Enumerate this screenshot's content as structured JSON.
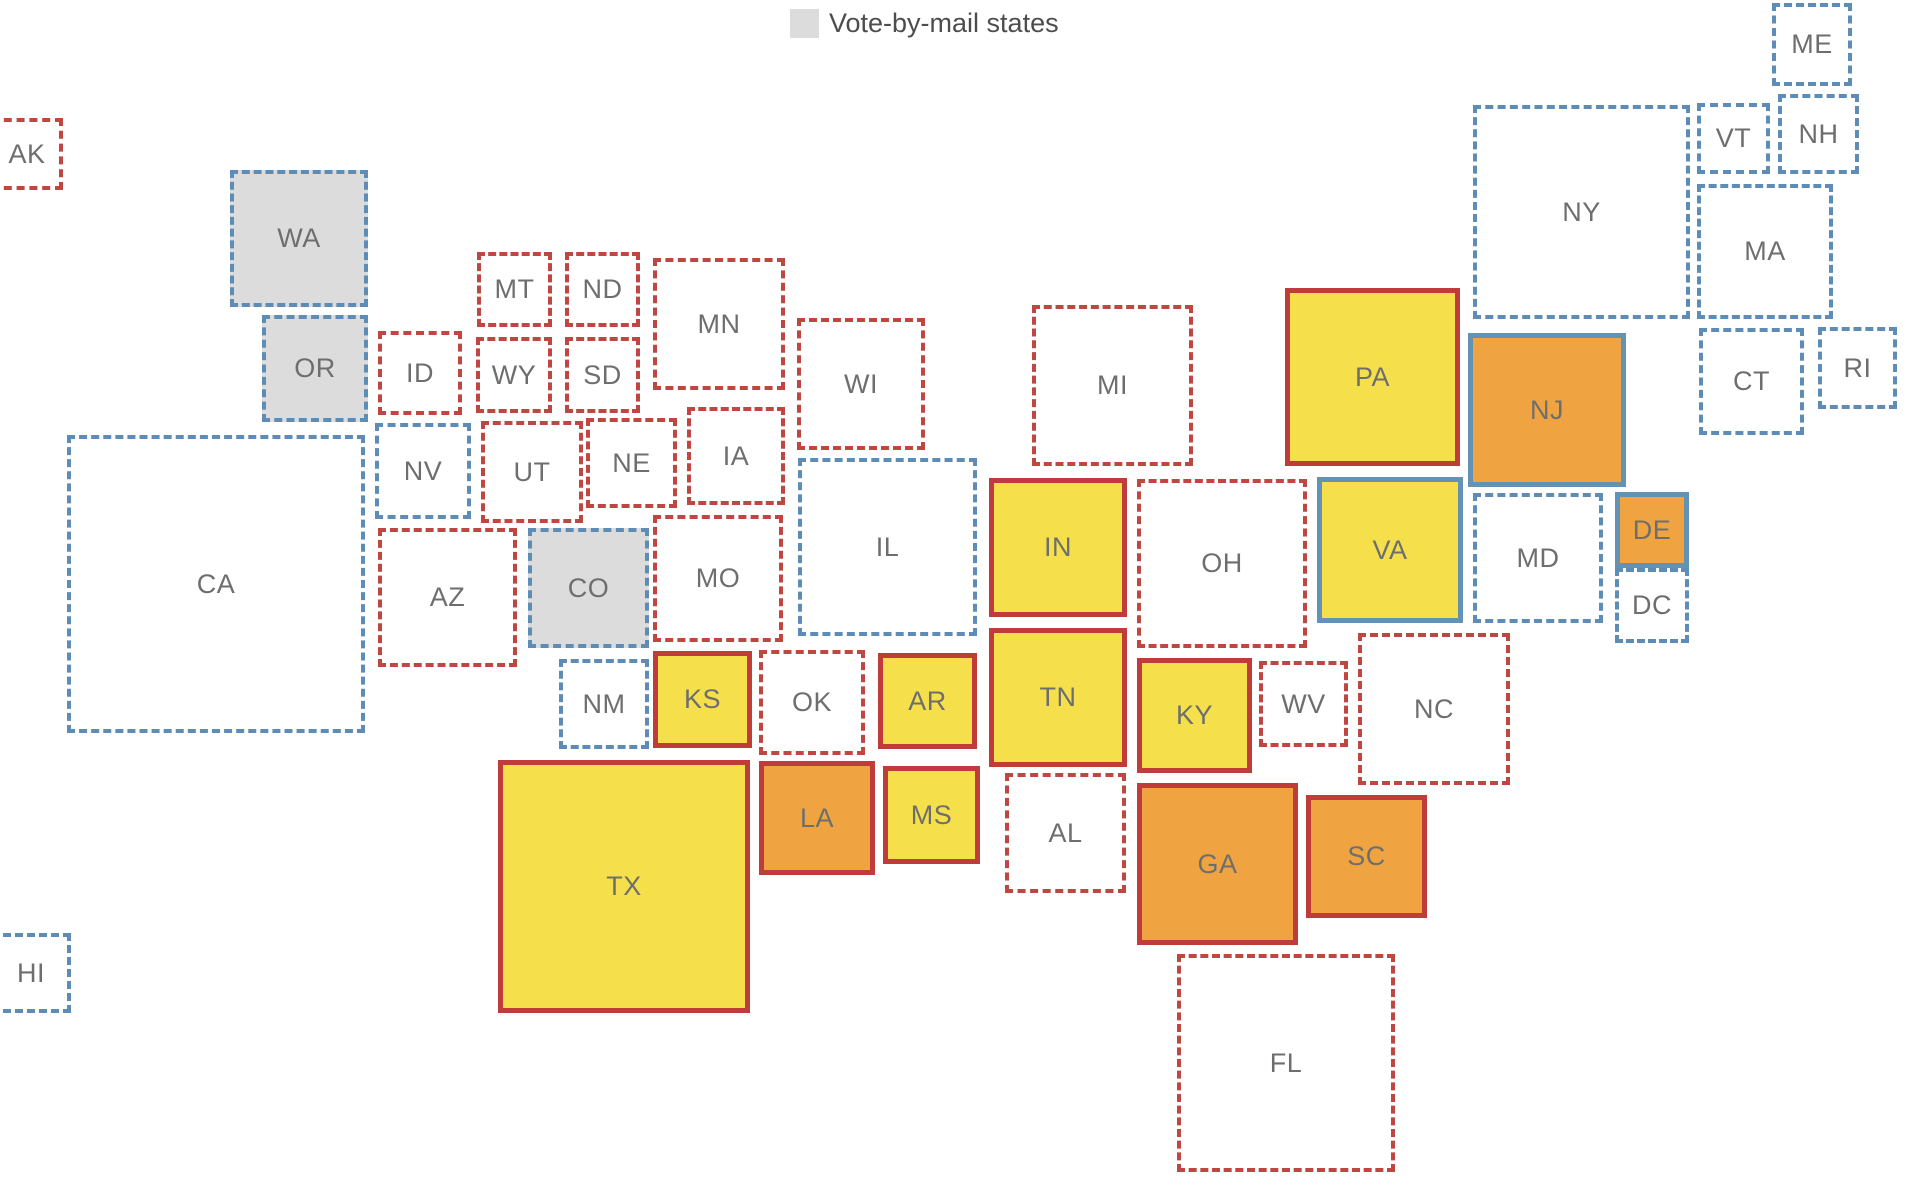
{
  "canvas": {
    "width": 1910,
    "height": 1204,
    "background": "#ffffff"
  },
  "legend": {
    "label": "Vote-by-mail states",
    "swatch": "gray-square"
  },
  "colors": {
    "yellow": "#f5e04b",
    "orange": "#f0a441",
    "gray_fill": "#dcdcdc",
    "red_solid_border": "#c03c3a",
    "blue_solid_border": "#6492b5",
    "red_dashed_border": "#c04641",
    "blue_dashed_border": "#5d8db6",
    "state_label": "#6e6e6e",
    "legend_text": "#4d4d4d"
  },
  "states": [
    {
      "abbr": "AK",
      "x": -9,
      "y": 118,
      "w": 72,
      "h": 72,
      "fill": "white",
      "border": "red-dashed"
    },
    {
      "abbr": "HI",
      "x": -9,
      "y": 933,
      "w": 80,
      "h": 80,
      "fill": "white",
      "border": "blue-dashed"
    },
    {
      "abbr": "WA",
      "x": 230,
      "y": 170,
      "w": 138,
      "h": 137,
      "fill": "gray",
      "border": "blue-dashed"
    },
    {
      "abbr": "OR",
      "x": 262,
      "y": 315,
      "w": 106,
      "h": 107,
      "fill": "gray",
      "border": "blue-dashed"
    },
    {
      "abbr": "CA",
      "x": 67,
      "y": 435,
      "w": 298,
      "h": 298,
      "fill": "white",
      "border": "blue-dashed"
    },
    {
      "abbr": "ID",
      "x": 378,
      "y": 331,
      "w": 84,
      "h": 84,
      "fill": "white",
      "border": "red-dashed"
    },
    {
      "abbr": "NV",
      "x": 375,
      "y": 423,
      "w": 96,
      "h": 96,
      "fill": "white",
      "border": "blue-dashed"
    },
    {
      "abbr": "UT",
      "x": 481,
      "y": 421,
      "w": 102,
      "h": 102,
      "fill": "white",
      "border": "red-dashed"
    },
    {
      "abbr": "AZ",
      "x": 378,
      "y": 528,
      "w": 139,
      "h": 139,
      "fill": "white",
      "border": "red-dashed"
    },
    {
      "abbr": "NM",
      "x": 559,
      "y": 659,
      "w": 90,
      "h": 90,
      "fill": "white",
      "border": "blue-dashed"
    },
    {
      "abbr": "MT",
      "x": 477,
      "y": 252,
      "w": 75,
      "h": 75,
      "fill": "white",
      "border": "red-dashed"
    },
    {
      "abbr": "ND",
      "x": 565,
      "y": 252,
      "w": 75,
      "h": 75,
      "fill": "white",
      "border": "red-dashed"
    },
    {
      "abbr": "WY",
      "x": 476,
      "y": 337,
      "w": 76,
      "h": 76,
      "fill": "white",
      "border": "red-dashed"
    },
    {
      "abbr": "SD",
      "x": 565,
      "y": 337,
      "w": 75,
      "h": 76,
      "fill": "white",
      "border": "red-dashed"
    },
    {
      "abbr": "NE",
      "x": 586,
      "y": 418,
      "w": 91,
      "h": 90,
      "fill": "white",
      "border": "red-dashed"
    },
    {
      "abbr": "CO",
      "x": 528,
      "y": 528,
      "w": 121,
      "h": 120,
      "fill": "gray",
      "border": "blue-dashed"
    },
    {
      "abbr": "KS",
      "x": 653,
      "y": 651,
      "w": 99,
      "h": 97,
      "fill": "yellow",
      "border": "red-solid"
    },
    {
      "abbr": "OK",
      "x": 759,
      "y": 650,
      "w": 106,
      "h": 105,
      "fill": "white",
      "border": "red-dashed"
    },
    {
      "abbr": "TX",
      "x": 498,
      "y": 760,
      "w": 252,
      "h": 253,
      "fill": "yellow",
      "border": "red-solid"
    },
    {
      "abbr": "MN",
      "x": 653,
      "y": 258,
      "w": 132,
      "h": 132,
      "fill": "white",
      "border": "red-dashed"
    },
    {
      "abbr": "IA",
      "x": 687,
      "y": 407,
      "w": 98,
      "h": 98,
      "fill": "white",
      "border": "red-dashed"
    },
    {
      "abbr": "MO",
      "x": 653,
      "y": 515,
      "w": 130,
      "h": 127,
      "fill": "white",
      "border": "red-dashed"
    },
    {
      "abbr": "WI",
      "x": 797,
      "y": 318,
      "w": 128,
      "h": 132,
      "fill": "white",
      "border": "red-dashed"
    },
    {
      "abbr": "IL",
      "x": 798,
      "y": 458,
      "w": 179,
      "h": 178,
      "fill": "white",
      "border": "blue-dashed"
    },
    {
      "abbr": "MI",
      "x": 1032,
      "y": 305,
      "w": 161,
      "h": 161,
      "fill": "white",
      "border": "red-dashed"
    },
    {
      "abbr": "IN",
      "x": 989,
      "y": 478,
      "w": 138,
      "h": 139,
      "fill": "yellow",
      "border": "red-solid"
    },
    {
      "abbr": "OH",
      "x": 1137,
      "y": 479,
      "w": 170,
      "h": 169,
      "fill": "white",
      "border": "red-dashed"
    },
    {
      "abbr": "KY",
      "x": 1137,
      "y": 658,
      "w": 115,
      "h": 115,
      "fill": "yellow",
      "border": "red-solid"
    },
    {
      "abbr": "TN",
      "x": 989,
      "y": 628,
      "w": 138,
      "h": 139,
      "fill": "yellow",
      "border": "red-solid"
    },
    {
      "abbr": "WV",
      "x": 1259,
      "y": 661,
      "w": 89,
      "h": 86,
      "fill": "white",
      "border": "red-dashed"
    },
    {
      "abbr": "AR",
      "x": 878,
      "y": 653,
      "w": 99,
      "h": 96,
      "fill": "yellow",
      "border": "red-solid"
    },
    {
      "abbr": "LA",
      "x": 759,
      "y": 761,
      "w": 116,
      "h": 114,
      "fill": "orange",
      "border": "red-solid"
    },
    {
      "abbr": "MS",
      "x": 883,
      "y": 766,
      "w": 97,
      "h": 98,
      "fill": "yellow",
      "border": "red-solid"
    },
    {
      "abbr": "AL",
      "x": 1005,
      "y": 773,
      "w": 121,
      "h": 120,
      "fill": "white",
      "border": "red-dashed"
    },
    {
      "abbr": "GA",
      "x": 1137,
      "y": 783,
      "w": 161,
      "h": 162,
      "fill": "orange",
      "border": "red-solid"
    },
    {
      "abbr": "SC",
      "x": 1306,
      "y": 795,
      "w": 121,
      "h": 123,
      "fill": "orange",
      "border": "red-solid"
    },
    {
      "abbr": "NC",
      "x": 1358,
      "y": 633,
      "w": 152,
      "h": 152,
      "fill": "white",
      "border": "red-dashed"
    },
    {
      "abbr": "VA",
      "x": 1317,
      "y": 477,
      "w": 146,
      "h": 146,
      "fill": "yellow",
      "border": "blue-solid"
    },
    {
      "abbr": "FL",
      "x": 1177,
      "y": 954,
      "w": 218,
      "h": 218,
      "fill": "white",
      "border": "red-dashed"
    },
    {
      "abbr": "PA",
      "x": 1285,
      "y": 288,
      "w": 175,
      "h": 178,
      "fill": "yellow",
      "border": "red-solid"
    },
    {
      "abbr": "NY",
      "x": 1473,
      "y": 105,
      "w": 217,
      "h": 214,
      "fill": "white",
      "border": "blue-dashed"
    },
    {
      "abbr": "NJ",
      "x": 1468,
      "y": 333,
      "w": 158,
      "h": 154,
      "fill": "orange",
      "border": "blue-solid"
    },
    {
      "abbr": "MD",
      "x": 1473,
      "y": 493,
      "w": 130,
      "h": 130,
      "fill": "white",
      "border": "blue-dashed"
    },
    {
      "abbr": "DE",
      "x": 1615,
      "y": 492,
      "w": 74,
      "h": 76,
      "fill": "orange",
      "border": "blue-solid"
    },
    {
      "abbr": "DC",
      "x": 1615,
      "y": 568,
      "w": 74,
      "h": 75,
      "fill": "white",
      "border": "blue-dashed"
    },
    {
      "abbr": "VT",
      "x": 1697,
      "y": 103,
      "w": 73,
      "h": 71,
      "fill": "white",
      "border": "blue-dashed"
    },
    {
      "abbr": "NH",
      "x": 1778,
      "y": 94,
      "w": 81,
      "h": 80,
      "fill": "white",
      "border": "blue-dashed"
    },
    {
      "abbr": "MA",
      "x": 1697,
      "y": 184,
      "w": 136,
      "h": 135,
      "fill": "white",
      "border": "blue-dashed"
    },
    {
      "abbr": "CT",
      "x": 1699,
      "y": 328,
      "w": 105,
      "h": 107,
      "fill": "white",
      "border": "blue-dashed"
    },
    {
      "abbr": "RI",
      "x": 1818,
      "y": 327,
      "w": 79,
      "h": 82,
      "fill": "white",
      "border": "blue-dashed"
    },
    {
      "abbr": "ME",
      "x": 1772,
      "y": 3,
      "w": 80,
      "h": 83,
      "fill": "white",
      "border": "blue-dashed"
    }
  ]
}
